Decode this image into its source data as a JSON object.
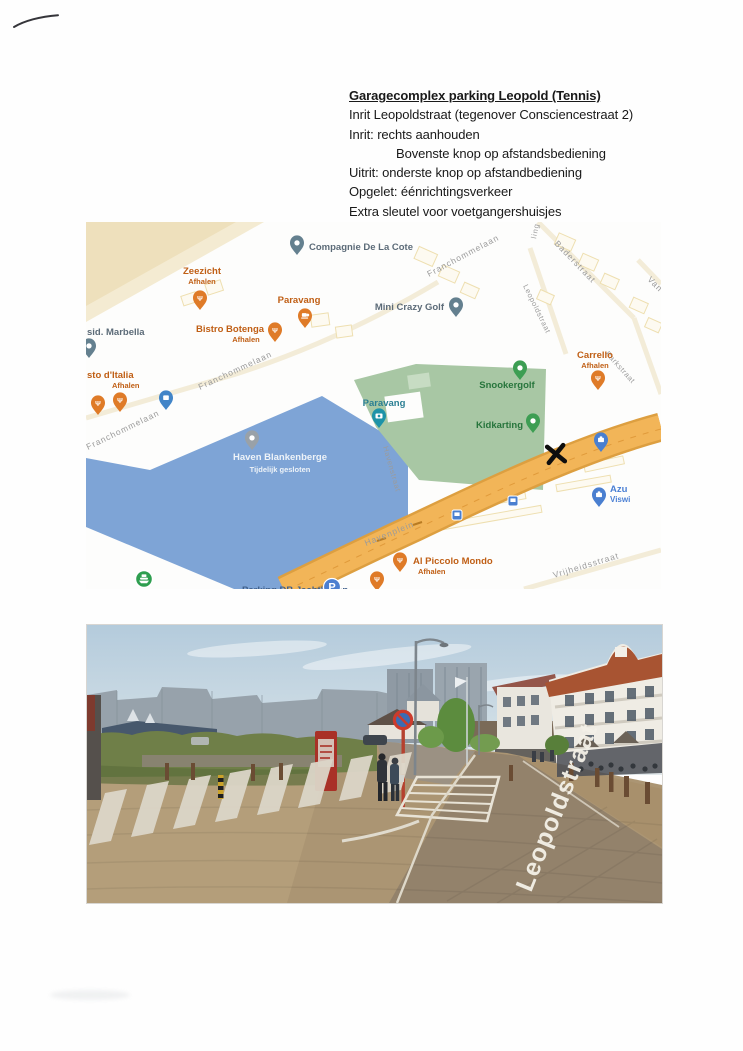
{
  "document": {
    "title": "Garagecomplex parking Leopold (Tennis)",
    "lines": [
      "Inrit Leopoldstraat (tegenover Consciencestraat 2)",
      "Inrit: rechts aanhouden",
      "Bovenste knop op afstandsbediening",
      "Uitrit: onderste knop op afstandbediening",
      "Opgelet: éénrichtingsverkeer",
      "Extra sleutel voor voetgangershuisjes"
    ]
  },
  "map": {
    "pois": {
      "compagnie": {
        "name": "Compagnie De La Cote"
      },
      "zeezicht": {
        "name": "Zeezicht",
        "sub": "Afhalen"
      },
      "paravang_cafe": {
        "name": "Paravang"
      },
      "bistro": {
        "name": "Bistro Botenga",
        "sub": "Afhalen"
      },
      "marbella": {
        "name": "sid. Marbella"
      },
      "minigolf": {
        "name": "Mini Crazy Golf"
      },
      "italia": {
        "name": "sto d'Italia",
        "sub": "Afhalen"
      },
      "carrello": {
        "name": "Carrello",
        "sub": "Afhalen"
      },
      "snookergolf": {
        "name": "Snookergolf"
      },
      "paravang_attraction": {
        "name": "Paravang"
      },
      "kidkarting": {
        "name": "Kidkarting"
      },
      "haven": {
        "name": "Haven Blankenberge",
        "sub": "Tijdelijk gesloten"
      },
      "azur": {
        "name": "Azu",
        "sub": "Viswi"
      },
      "piccolo": {
        "name": "Al Piccolo Mondo",
        "sub": "Afhalen"
      },
      "parking": {
        "name": "Parking DB  Jachthaven"
      }
    },
    "streets": {
      "franchommelaan1": "Franchommelaan",
      "franchommelaan2": "Franchommelaan",
      "franchommelaan3": "Franchommelaan",
      "baderstraat": "Baderstraat",
      "leopoldstraat": "Leopoldstraat",
      "parkstraat": "Parkstraat",
      "havenstraat": "Havenstraat",
      "havenplein": "Havenplein",
      "vrijheidsstraat": "Vrijheidsstraat",
      "van_partial": "Van",
      "ling_partial": "ling"
    }
  },
  "street_view": {
    "street_label": "Leopoldstraat"
  },
  "icons": {
    "restaurant_glyph": "Ψ",
    "parking_glyph": "P"
  },
  "colors": {
    "harbor_water": "#7ea4d6",
    "main_road": "#efb052",
    "park_green": "#a8c7a4",
    "beach_sand": "#efe2c0",
    "restaurant_pin": "#df7b28",
    "attraction_pin": "#1d93a8",
    "transit_blue": "#4a7fd0",
    "handwritten_x": "#111111",
    "roof_red": "#a85432"
  }
}
